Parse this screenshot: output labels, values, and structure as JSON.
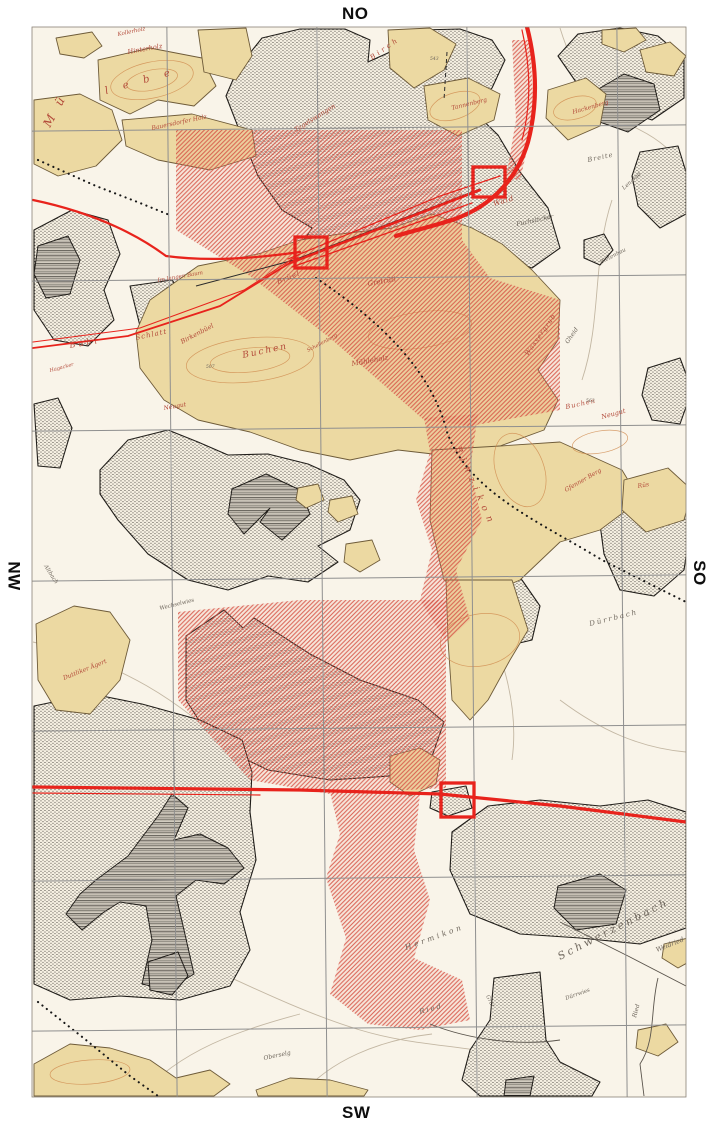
{
  "compass": {
    "top": "NO",
    "right": "SO",
    "bottom": "SW",
    "left": "NW"
  },
  "colors": {
    "map_bg": "#f9f4e9",
    "beige": "#ecd9a2",
    "beige_stroke": "#6e5b39",
    "forest_bg": "#f7f1e3",
    "dot": "#211e1a",
    "red": "#e8231c",
    "red_hatch": "#d64f42",
    "red_wash": "rgba(233,138,125,0.13)",
    "grid": "#8f8f8f",
    "label_red": "#b34a3a",
    "label_dark": "#6e665c",
    "contour": "#d08a4e",
    "road": "#c3b7a3",
    "boundary": "#5a544c",
    "black_line": "#2b2b2b"
  },
  "map": {
    "frame": {
      "x": 32,
      "y": 27,
      "w": 654,
      "h": 1070
    },
    "grid": {
      "vertical_x": [
        172,
        322,
        472,
        622
      ],
      "horizontal_y": [
        128,
        278,
        428,
        578,
        728,
        878,
        1028
      ],
      "tilt_deg": -0.55
    },
    "red_squares": [
      {
        "x": 295,
        "y": 237,
        "w": 32,
        "h": 31
      },
      {
        "x": 473,
        "y": 167,
        "w": 32,
        "h": 30
      },
      {
        "x": 441,
        "y": 783,
        "w": 33,
        "h": 34
      }
    ],
    "forest_polygons": [
      "238,68 262,38 300,29 345,29 370,40 368,62 390,52 420,30 460,29 492,40 505,60 492,88 470,108 498,135 520,172 548,208 560,248 532,268 492,255 462,270 432,256 400,266 362,250 330,262 300,246 312,228 282,210 258,176 240,132 226,96",
      "558,56 578,34 620,28 658,36 684,58 684,98 652,120 612,106 576,82",
      "640,152 678,146 686,172 686,214 660,228 638,206 632,176",
      "34,230 72,210 108,220 120,254 104,290 114,320 88,346 54,340 34,310",
      "34,404 58,398 72,428 60,468 38,466",
      "130,286 172,280 190,304 170,330 140,326",
      "584,240 604,234 613,250 600,265 584,258",
      "648,368 680,358 692,390 680,424 652,420 642,395",
      "100,470 128,440 168,430 198,442 228,455 268,454 308,464 344,480 360,500 350,530 318,546 338,562 308,582 268,576 228,590 188,580 148,554 118,520 100,494",
      "462,574 500,562 522,580 540,606 532,640 498,648 470,626 458,598",
      "608,504 650,488 682,494 690,530 684,570 654,596 620,590 604,554 600,524",
      "186,636 224,610 243,628 254,618 310,654 360,680 418,700 444,722 430,762 390,776 330,780 268,770 214,744 186,700",
      "34,706 92,694 142,704 200,720 242,740 252,772 250,812 256,860 240,912 250,950 230,986 180,1000 120,996 70,1000 34,984",
      "452,832 488,806 540,800 600,806 648,800 686,812 686,928 640,944 580,938 520,934 470,914 450,870",
      "494,978 540,972 546,1040 560,1062 600,1082 592,1096 480,1096 462,1080 470,1050 490,1020",
      "432,792 466,786 472,808 448,816 430,808"
    ],
    "dark_hatch_polygons": [
      "590,94 624,74 654,84 660,110 628,132 594,120",
      "38,246 68,236 80,260 70,294 46,298 34,274",
      "232,489 266,474 300,490 310,514 282,540 260,522 270,508 244,534 228,514",
      "96,880 128,856 158,816 172,794 188,808 174,840 200,834 228,848 244,868 224,884 196,880 176,896 184,930 194,974 168,990 142,984 152,940 146,906 120,902 104,912 82,930 66,914 80,894",
      "558,886 600,874 626,890 616,924 576,930 554,908",
      "506,1080 534,1076 530,1096 504,1096",
      "148,962 178,952 188,976 172,995 150,990"
    ],
    "beige_polygons": [
      "98,60 150,48 202,58 216,86 194,106 158,100 130,114 100,100",
      "34,100 80,94 112,110 122,140 96,166 58,176 34,164",
      "122,120 192,114 252,130 256,156 210,170 158,160 126,146",
      "56,38 92,32 102,46 84,58 60,54",
      "198,30 246,28 252,56 236,80 204,72",
      "388,30 430,28 456,44 444,70 414,88 390,68",
      "424,86 468,78 500,94 494,120 458,136 428,120",
      "548,90 586,78 606,94 600,126 568,140 546,118",
      "602,30 636,28 646,40 624,52 602,44",
      "640,50 670,42 686,56 674,76 646,72",
      "150,300 198,266 258,254 300,240 340,234 392,228 432,214 472,228 502,244 532,270 560,300 558,340 538,370 558,400 544,430 500,446 450,456 398,450 350,460 300,450 250,432 198,420 164,400 140,368 136,332",
      "432,450 500,446 560,442 622,470 640,500 600,530 560,542 520,580 474,600 444,580 430,520",
      "446,580 512,580 528,630 510,660 488,700 470,720 452,700 448,640",
      "36,624 74,606 110,612 130,640 120,680 90,714 56,710 38,680",
      "624,480 668,468 692,490 684,520 646,532 622,510",
      "34,1064 70,1044 110,1048 150,1060 176,1078 210,1070 230,1084 214,1096 34,1096",
      "256,1090 290,1078 330,1080 368,1090 364,1096 258,1096",
      "664,944 688,938 696,958 678,968 662,958",
      "638,1030 666,1024 678,1042 658,1056 636,1048",
      "346,544 372,540 380,560 360,572 344,562",
      "298,488 318,484 324,500 306,508 296,500",
      "330,500 352,496 358,514 338,522 328,512",
      "390,756 420,748 440,760 436,784 410,796 390,782"
    ],
    "red_hatch_polygons": [
      "176,130 462,130 462,240 490,278 560,300 560,410 470,426 424,420 330,338 250,276 176,230",
      "424,418 478,414 470,470 482,520 456,570 470,620 446,642 420,600 432,550 416,500 430,452",
      "178,612 300,600 446,600 446,788 330,794 250,780 178,700",
      "330,792 420,794 414,850 430,900 414,958 462,980 470,1020 420,1030 368,1024 330,994 346,938 326,878 340,834",
      "512,40 530,40 534,120 520,180 506,178 516,120"
    ],
    "red_lines": [
      {
        "d": "M33,200 C100,214 142,238 166,256 C210,262 258,258 300,252",
        "w": 2.2
      },
      {
        "d": "M33,348 L128,336 L220,306 L298,258",
        "w": 1.8
      },
      {
        "d": "M33,342 L140,328 L244,290 L300,254",
        "w": 1.0
      },
      {
        "d": "M290,263 L480,190",
        "w": 2.6
      },
      {
        "d": "M292,267 L472,203",
        "w": 1.3
      },
      {
        "d": "M288,259 L440,196 L500,176",
        "w": 1.2
      },
      {
        "d": "M527,27 C536,62 539,100 528,142 C518,176 494,206 452,220 C430,227 412,231 396,236",
        "w": 4.2
      },
      {
        "d": "M522,30 C530,64 532,102 522,140",
        "w": 1.2
      },
      {
        "d": "M33,787 L300,790 L440,794 L560,806 L686,822",
        "w": 3.2
      },
      {
        "d": "M33,793 L260,795",
        "w": 1.2
      }
    ],
    "black_lines": [
      {
        "d": "M196,286 L294,260 L480,189",
        "w": 1.0,
        "dash": ""
      },
      {
        "d": "M447,52 L444,100",
        "w": 1.0,
        "dash": "4 3"
      }
    ],
    "dotted_paths": [
      "M38,160 L96,186 L140,203 L172,216",
      "M316,278 C382,322 432,372 447,432 C468,492 540,522 602,560 L686,602",
      "M38,1002 L86,1040 L130,1076 L158,1096"
    ],
    "boundaries": [
      "M560,922 L628,956 L686,986",
      "M658,978 C650,1010 656,1040 640,1064 L644,1096",
      "M430,1024 C470,1040 520,1046 560,1040"
    ],
    "roads": [
      "M33,898 C150,930 260,1000 360,1030 C420,1048 470,1044 520,1060",
      "M560,28 C576,80 600,110 640,130 C664,142 678,158 686,170",
      "M300,1096 C330,1060 380,1040 432,1034",
      "M33,642 C120,662 180,700 240,758",
      "M480,602 C500,652 520,702 512,760",
      "M612,200 C592,260 602,320 582,380",
      "M140,1096 C180,1050 240,1030 300,1014",
      "M560,700 C600,730 640,748 686,752",
      "M360,60 C350,120 330,170 300,220"
    ],
    "contours": [
      {
        "cx": 152,
        "cy": 80,
        "rx": 42,
        "ry": 18,
        "r": -12
      },
      {
        "cx": 152,
        "cy": 80,
        "rx": 26,
        "ry": 10,
        "r": -12
      },
      {
        "cx": 455,
        "cy": 106,
        "rx": 26,
        "ry": 13,
        "r": -18
      },
      {
        "cx": 575,
        "cy": 108,
        "rx": 22,
        "ry": 11,
        "r": -15
      },
      {
        "cx": 250,
        "cy": 360,
        "rx": 64,
        "ry": 22,
        "r": -6
      },
      {
        "cx": 250,
        "cy": 360,
        "rx": 40,
        "ry": 12,
        "r": -6
      },
      {
        "cx": 420,
        "cy": 330,
        "rx": 52,
        "ry": 18,
        "r": -8
      },
      {
        "cx": 520,
        "cy": 470,
        "rx": 38,
        "ry": 24,
        "r": 70
      },
      {
        "cx": 90,
        "cy": 1072,
        "rx": 40,
        "ry": 12,
        "r": -4
      },
      {
        "cx": 600,
        "cy": 442,
        "rx": 28,
        "ry": 11,
        "r": -10
      },
      {
        "cx": 480,
        "cy": 640,
        "rx": 26,
        "ry": 40,
        "r": 80
      }
    ],
    "labels": [
      {
        "t": "Hinterholz",
        "x": 128,
        "y": 54,
        "r": -10,
        "s": 6.5,
        "c": "r",
        "ls": 0
      },
      {
        "t": "Kollerholz",
        "x": 118,
        "y": 36,
        "r": -12,
        "s": 5.5,
        "c": "r",
        "ls": 0
      },
      {
        "t": "M ü",
        "x": 50,
        "y": 128,
        "r": -62,
        "s": 12,
        "c": "r",
        "ls": 4
      },
      {
        "t": "l e b e",
        "x": 106,
        "y": 94,
        "r": -16,
        "s": 10,
        "c": "r",
        "ls": 6
      },
      {
        "t": "Bauersdorfer Holz",
        "x": 152,
        "y": 130,
        "r": -12,
        "s": 6,
        "c": "r",
        "ls": 0
      },
      {
        "t": "Tagelswangen",
        "x": 296,
        "y": 132,
        "r": -32,
        "s": 6.5,
        "c": "r",
        "ls": 0
      },
      {
        "t": "Birch",
        "x": 372,
        "y": 60,
        "r": -35,
        "s": 7,
        "c": "r",
        "ls": 3
      },
      {
        "t": "Tannenberg",
        "x": 452,
        "y": 110,
        "r": -14,
        "s": 6,
        "c": "r",
        "ls": 0
      },
      {
        "t": "Hackenberg",
        "x": 573,
        "y": 114,
        "r": -16,
        "s": 6,
        "c": "r",
        "ls": 0
      },
      {
        "t": "Breite",
        "x": 588,
        "y": 162,
        "r": -12,
        "s": 6.5,
        "c": "k",
        "ls": 1
      },
      {
        "t": "Lengrad",
        "x": 624,
        "y": 190,
        "r": -42,
        "s": 5.5,
        "c": "k",
        "ls": 0
      },
      {
        "t": "Buhl",
        "x": 70,
        "y": 348,
        "r": -10,
        "s": 8,
        "c": "r",
        "ls": 3
      },
      {
        "t": "Schlatt",
        "x": 136,
        "y": 340,
        "r": -12,
        "s": 7,
        "c": "r",
        "ls": 1
      },
      {
        "t": "Hagacker",
        "x": 50,
        "y": 372,
        "r": -15,
        "s": 5,
        "c": "r",
        "ls": 0
      },
      {
        "t": "Im langen Baum",
        "x": 158,
        "y": 282,
        "r": -10,
        "s": 5.5,
        "c": "r",
        "ls": 0
      },
      {
        "t": "Birkenbüel",
        "x": 182,
        "y": 344,
        "r": -28,
        "s": 6.5,
        "c": "r",
        "ls": 0
      },
      {
        "t": "Brüel",
        "x": 278,
        "y": 284,
        "r": -22,
        "s": 7,
        "c": "r",
        "ls": 1
      },
      {
        "t": "Buchen",
        "x": 243,
        "y": 358,
        "r": -12,
        "s": 9,
        "c": "r",
        "ls": 2
      },
      {
        "t": "Mühleholz",
        "x": 352,
        "y": 366,
        "r": -10,
        "s": 7,
        "c": "r",
        "ls": 0
      },
      {
        "t": "Gretrüti",
        "x": 368,
        "y": 286,
        "r": -10,
        "s": 7,
        "c": "r",
        "ls": 0
      },
      {
        "t": "Wald",
        "x": 494,
        "y": 206,
        "r": -16,
        "s": 7,
        "c": "r",
        "ls": 1
      },
      {
        "t": "Fuchslöcher",
        "x": 517,
        "y": 226,
        "r": -12,
        "s": 6,
        "c": "k",
        "ls": 0
      },
      {
        "t": "Bietenhau",
        "x": 601,
        "y": 264,
        "r": -28,
        "s": 5.5,
        "c": "k",
        "ls": 0
      },
      {
        "t": "Wassergrub",
        "x": 528,
        "y": 356,
        "r": -55,
        "s": 6.5,
        "c": "r",
        "ls": 1
      },
      {
        "t": "Gheid",
        "x": 568,
        "y": 344,
        "r": -55,
        "s": 6,
        "c": "k",
        "ls": 0
      },
      {
        "t": "Schellenberg",
        "x": 308,
        "y": 352,
        "r": -28,
        "s": 5,
        "c": "r",
        "ls": 0
      },
      {
        "t": "Neugut",
        "x": 164,
        "y": 410,
        "r": -10,
        "s": 6,
        "c": "r",
        "ls": 0
      },
      {
        "t": "Binzikon",
        "x": 455,
        "y": 448,
        "r": 66,
        "s": 9,
        "c": "r",
        "ls": 6
      },
      {
        "t": "Buchen",
        "x": 566,
        "y": 409,
        "r": -12,
        "s": 6.5,
        "c": "r",
        "ls": 1
      },
      {
        "t": "Neugut",
        "x": 602,
        "y": 419,
        "r": -15,
        "s": 6.5,
        "c": "r",
        "ls": 0
      },
      {
        "t": "Gfenner Berg",
        "x": 566,
        "y": 492,
        "r": -30,
        "s": 6,
        "c": "r",
        "ls": 0
      },
      {
        "t": "Rüs",
        "x": 638,
        "y": 488,
        "r": -10,
        "s": 6,
        "c": "r",
        "ls": 0
      },
      {
        "t": "Altbach",
        "x": 44,
        "y": 566,
        "r": 58,
        "s": 5.5,
        "c": "k",
        "ls": 0
      },
      {
        "t": "Wechselwies",
        "x": 160,
        "y": 610,
        "r": -14,
        "s": 5.5,
        "c": "k",
        "ls": 0
      },
      {
        "t": "Duttliker Ägert",
        "x": 64,
        "y": 680,
        "r": -22,
        "s": 6,
        "c": "r",
        "ls": 0
      },
      {
        "t": "Dürrbach",
        "x": 590,
        "y": 626,
        "r": -14,
        "s": 7,
        "c": "k",
        "ls": 2
      },
      {
        "t": "Hermikon",
        "x": 406,
        "y": 950,
        "r": -20,
        "s": 7.5,
        "c": "k",
        "ls": 3
      },
      {
        "t": "Schwerzenbach",
        "x": 560,
        "y": 960,
        "r": -27,
        "s": 10.5,
        "c": "k",
        "ls": 3
      },
      {
        "t": "Weidried",
        "x": 657,
        "y": 952,
        "r": -22,
        "s": 6.5,
        "c": "k",
        "ls": 0
      },
      {
        "t": "Ried",
        "x": 420,
        "y": 1014,
        "r": -15,
        "s": 7,
        "c": "k",
        "ls": 2
      },
      {
        "t": "Ried",
        "x": 636,
        "y": 1018,
        "r": -75,
        "s": 6,
        "c": "k",
        "ls": 0
      },
      {
        "t": "Dürrwies",
        "x": 566,
        "y": 1000,
        "r": -20,
        "s": 5.5,
        "c": "k",
        "ls": 0
      },
      {
        "t": "Grüt",
        "x": 486,
        "y": 996,
        "r": 65,
        "s": 5.5,
        "c": "k",
        "ls": 0
      },
      {
        "t": "Oberselg",
        "x": 264,
        "y": 1060,
        "r": -12,
        "s": 6,
        "c": "k",
        "ls": 0
      },
      {
        "t": "563",
        "x": 586,
        "y": 402,
        "r": 0,
        "s": 4.5,
        "c": "k",
        "ls": 0
      },
      {
        "t": "507",
        "x": 206,
        "y": 368,
        "r": 0,
        "s": 4.5,
        "c": "k",
        "ls": 0
      },
      {
        "t": "543",
        "x": 430,
        "y": 60,
        "r": 0,
        "s": 4.5,
        "c": "k",
        "ls": 0
      }
    ]
  }
}
